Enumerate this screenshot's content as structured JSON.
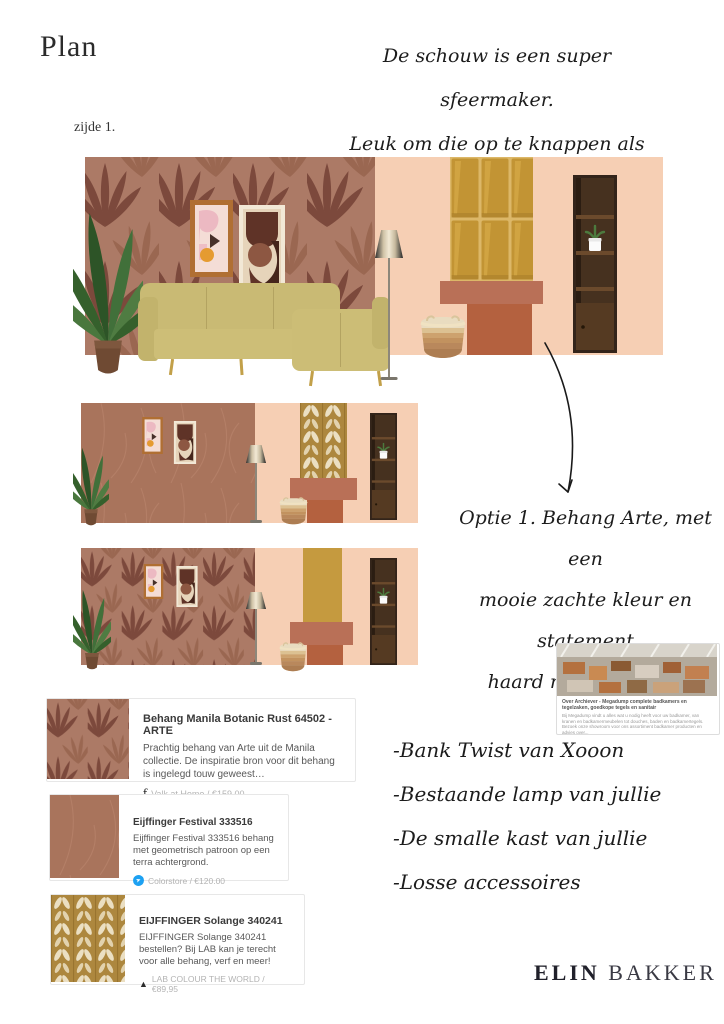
{
  "header": {
    "title": "Plan",
    "side_label": "zijde 1.",
    "note_lines": [
      "De schouw is een super sfeermaker.",
      "Leuk om die op te knappen als eye-",
      "catcher in de kamer!"
    ]
  },
  "annotation": {
    "option_note_lines": [
      "Optie 1. Behang Arte, met een",
      "mooie zachte kleur en statement",
      "haard met tegeltjes!"
    ]
  },
  "link_preview": {
    "title": "Over Archiever - Megadump complete badkamers en tegelzaken, goedkope tegels en sanitair",
    "description": "Bij Megadump vindt u alles wat u nodig heeft voor uw badkamer, van kranen en badkamermeubelen tot douches, baden en badkamertegels. Bezoek onze showroom voor ons assortiment badkamer producten en advies over...",
    "url_label": "Megadump complete badkamers en tegelzaken"
  },
  "product_cards": [
    {
      "title": "Behang Manila Botanic Rust 64502 - ARTE",
      "description": "Prachtig behang van Arte uit de Manila collectie. De inspiratie bron voor dit behang is ingelegd touw geweest…",
      "source": "Valk at Home / €159.00",
      "icon": "valk-at-home-logo",
      "icon_glyph": "ƒ"
    },
    {
      "title": "Eijffinger Festival 333516",
      "description": "Eijffinger Festival 333516 behang met geometrisch patroon op een terra achtergrond.",
      "source": "Colorstore / €120.00",
      "icon": "colorstore-bird-logo",
      "icon_glyph": "➤"
    },
    {
      "title": "EIJFFINGER Solange 340241",
      "description": "EIJFFINGER Solange 340241 bestellen? Bij LAB kan je terecht voor alle behang, verf en meer!",
      "source": "LAB COLOUR THE WORLD / €89,95",
      "icon": "lab-triangle-logo",
      "icon_glyph": "▲"
    }
  ],
  "furniture_list": [
    "-Bank Twist van Xooon",
    "-Bestaande lamp van jullie",
    "-De smalle kast van jullie",
    "-Losse accessoires"
  ],
  "brand": {
    "first": "ELIN",
    "last": "BAKKER"
  },
  "colors": {
    "wallpaper_bg": "#ac7a66",
    "wallpaper_leaf": "#7c493c",
    "wall_peach": "#f6cfb4",
    "wall_terracotta": "#a9745c",
    "tile_gold": "#c29434",
    "chevron_gold": "#ad873e",
    "chevron_cream": "#ebdfc2",
    "chimney_solid_gold": "#c59a3f",
    "mantel": "#b97057",
    "firebox": "#b4613f",
    "sofa": "#c9ba74",
    "ink": "#1c1c1c",
    "colorstore_blue": "#1da1f2"
  }
}
